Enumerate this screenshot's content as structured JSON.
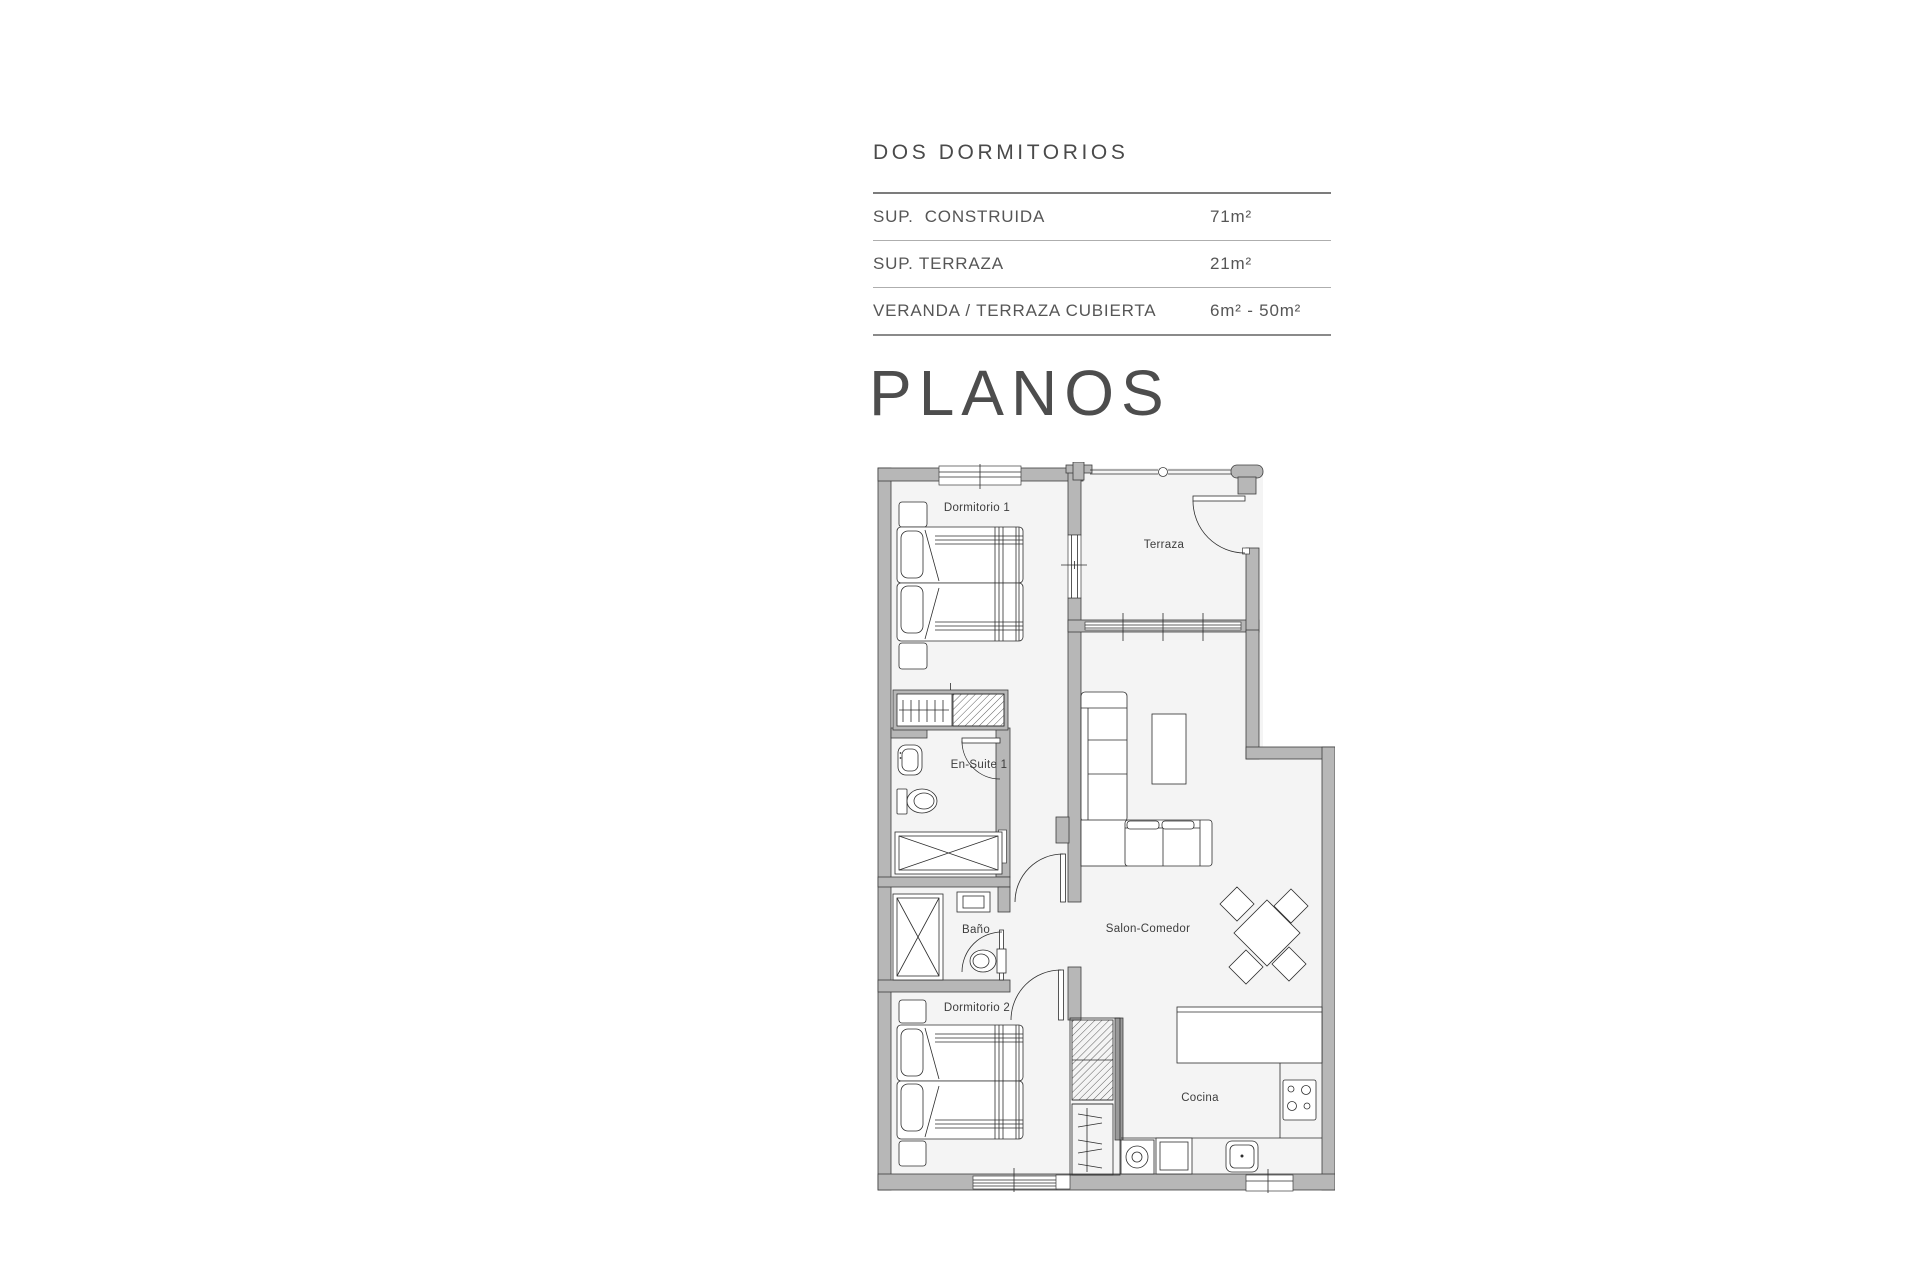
{
  "page": {
    "background": "#ffffff"
  },
  "summary": {
    "title": "DOS DORMITORIOS",
    "rows": [
      {
        "label": "SUP.  CONSTRUIDA",
        "value": "71m²"
      },
      {
        "label": "SUP. TERRAZA",
        "value": "21m²"
      },
      {
        "label": "VERANDA / TERRAZA CUBIERTA",
        "value": "6m² - 50m²"
      }
    ]
  },
  "plans_heading": "PLANOS",
  "floorplan": {
    "rooms": {
      "dormitorio1": "Dormitorio 1",
      "terraza": "Terraza",
      "ensuite1": "En-Suite 1",
      "bano": "Baño",
      "salon": "Salon-Comedor",
      "dormitorio2": "Dormitorio 2",
      "cocina": "Cocina"
    },
    "colors": {
      "wall_fill": "#b7b7b7",
      "wall_stroke": "#3e3e3e",
      "floor_fill": "#f4f4f4",
      "line": "#2e2e2e",
      "label_text": "#3d3d3d"
    }
  }
}
